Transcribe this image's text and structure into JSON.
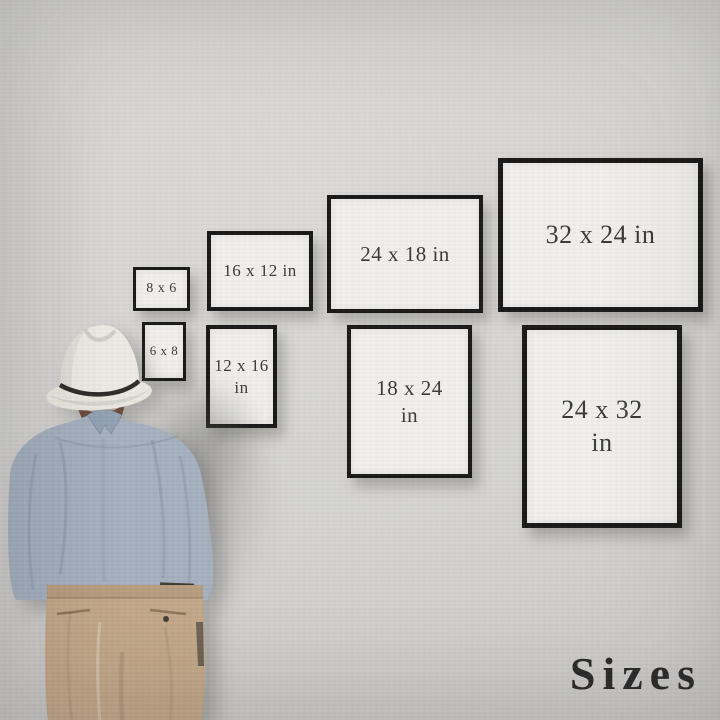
{
  "footer": {
    "label": "Sizes"
  },
  "frames": [
    {
      "id": "8x6",
      "row": "top",
      "orientation": "landscape",
      "line1": "8 x 6",
      "line2": ""
    },
    {
      "id": "16x12",
      "row": "top",
      "orientation": "landscape",
      "line1": "16 x 12 in",
      "line2": ""
    },
    {
      "id": "24x18",
      "row": "top",
      "orientation": "landscape",
      "line1": "24 x 18 in",
      "line2": ""
    },
    {
      "id": "32x24",
      "row": "top",
      "orientation": "landscape",
      "line1": "32 x 24 in",
      "line2": ""
    },
    {
      "id": "6x8",
      "row": "bottom",
      "orientation": "portrait",
      "line1": "6 x 8",
      "line2": ""
    },
    {
      "id": "12x16",
      "row": "bottom",
      "orientation": "portrait",
      "line1": "12 x 16",
      "line2": "in"
    },
    {
      "id": "18x24",
      "row": "bottom",
      "orientation": "portrait",
      "line1": "18 x 24",
      "line2": "in"
    },
    {
      "id": "24x32",
      "row": "bottom",
      "orientation": "portrait",
      "line1": "24 x 32",
      "line2": "in"
    }
  ],
  "colors": {
    "wall": "#d5d4d2",
    "frame_border": "#181818",
    "frame_paper": "#f1f0ee",
    "label_text": "#3a3a3a",
    "caption_text": "#2b2b2b",
    "hat": "#eeebe5",
    "hat_band": "#302c28",
    "hair": "#6b4a3a",
    "shirt": "#a5b1c0",
    "pants": "#c3a88a"
  }
}
